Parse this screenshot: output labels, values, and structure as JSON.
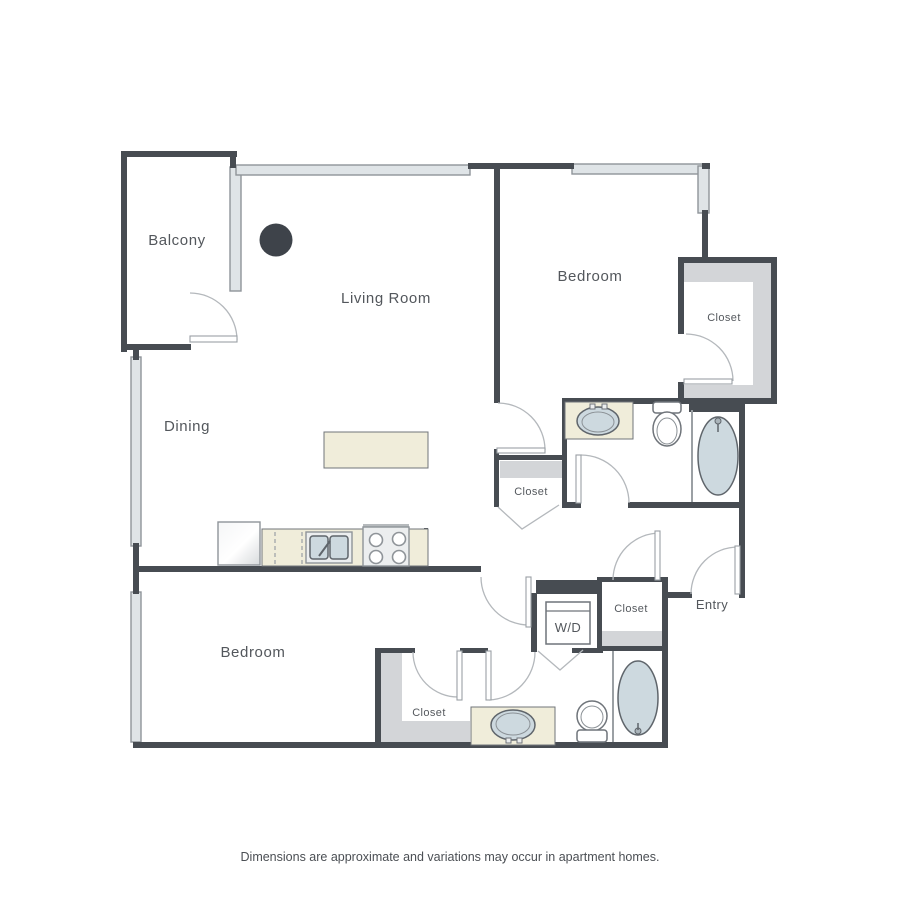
{
  "plan": {
    "labels": {
      "balcony": "Balcony",
      "living_room": "Living Room",
      "dining": "Dining",
      "bedroom_top": "Bedroom",
      "bedroom_bottom": "Bedroom",
      "closet_bedroom_top": "Closet",
      "closet_hall": "Closet",
      "closet_entry": "Closet",
      "closet_bedroom_bottom": "Closet",
      "laundry": "W/D",
      "entry": "Entry"
    },
    "footer": "Dimensions are approximate and variations may occur in apartment homes.",
    "colors": {
      "wall": "#474c52",
      "window_fill": "#dfe4e7",
      "closet_shelf_fill": "#d3d5d8",
      "counter_fill": "#f0edda",
      "fixture_fill": "#cdd9df",
      "door_arc": "#b4b8bc",
      "label_text": "#53575c",
      "column": "#3e434a"
    }
  }
}
